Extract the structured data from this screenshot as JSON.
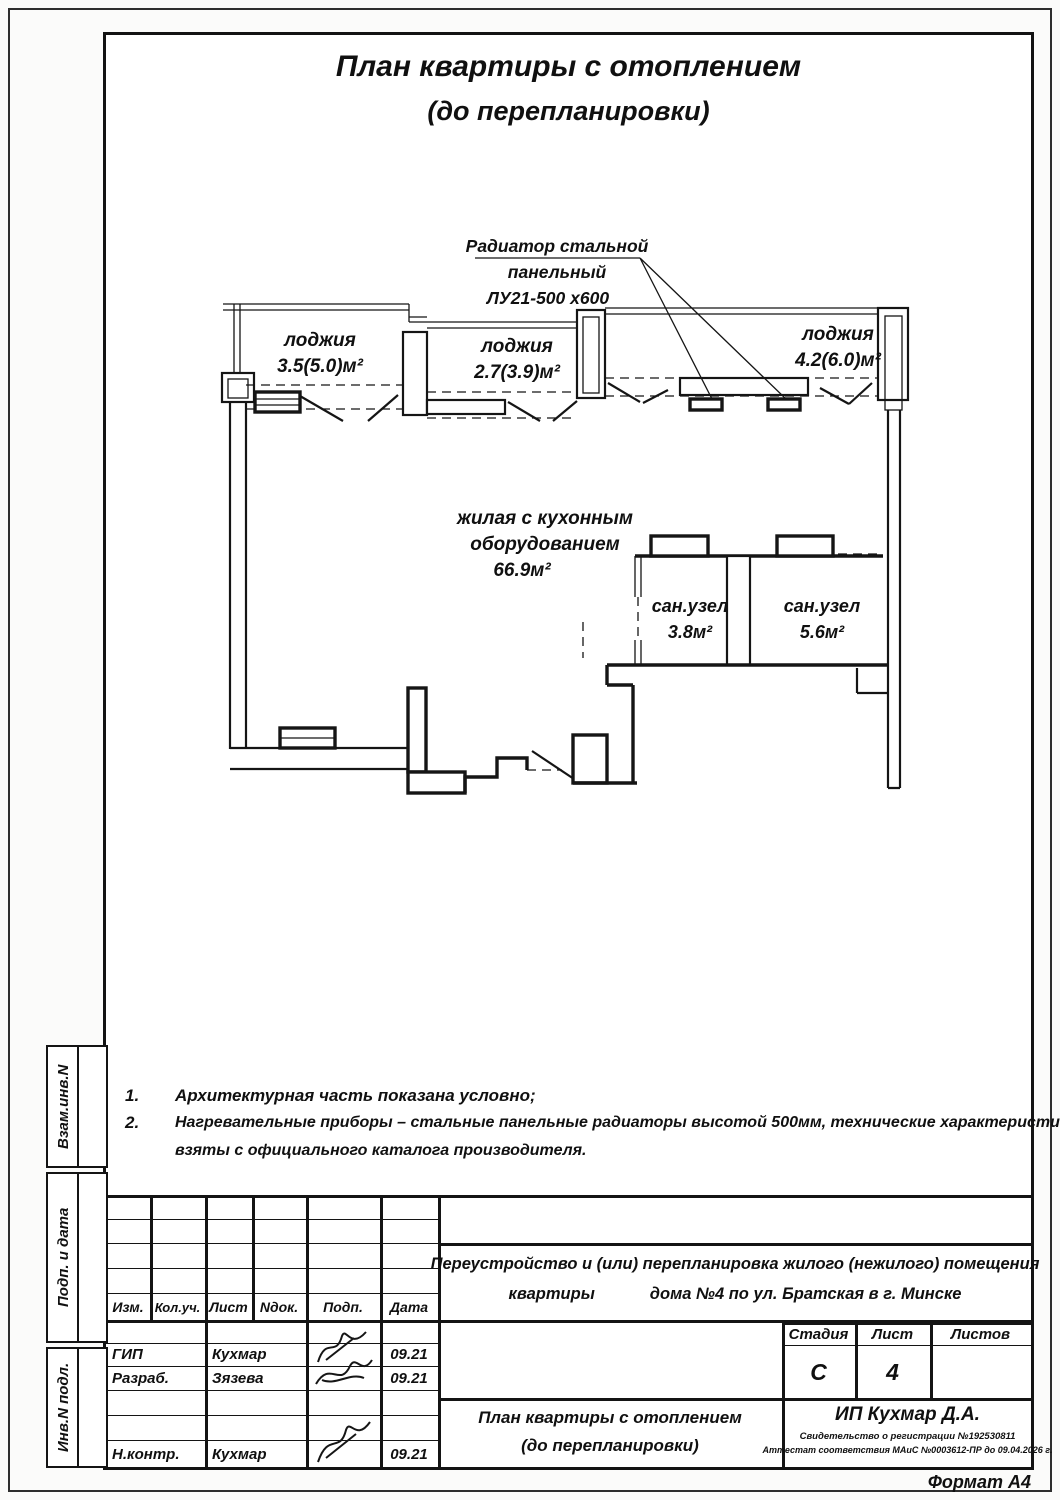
{
  "title": {
    "line1": "План квартиры с отоплением",
    "line2": "(до перепланировки)"
  },
  "plan": {
    "radiator_label": {
      "line1": "Радиатор стальной",
      "line2": "панельный",
      "line3": "ЛУ21-500 х600"
    },
    "loggia1": {
      "name": "лоджия",
      "area": "3.5(5.0)м²"
    },
    "loggia2": {
      "name": "лоджия",
      "area": "2.7(3.9)м²"
    },
    "loggia3": {
      "name": "лоджия",
      "area": "4.2(6.0)м²"
    },
    "living": {
      "line1": "жилая с кухонным",
      "line2": "оборудованием",
      "area": "66.9м²"
    },
    "san1": {
      "name": "сан.узел",
      "area": "3.8м²"
    },
    "san2": {
      "name": "сан.узел",
      "area": "5.6м²"
    }
  },
  "notes": {
    "item1": {
      "num": "1.",
      "text": "Архитектурная часть показана условно;"
    },
    "item2": {
      "num": "2.",
      "text": "Нагревательные приборы – стальные панельные радиаторы высотой 500мм, технические характеристики",
      "text2": "взяты с официального каталога производителя."
    }
  },
  "sidebar": {
    "group1": "Взам.инв.N",
    "group2": "Подп. и дата",
    "group3": "Инв.N подл."
  },
  "titleblock": {
    "columns": {
      "izm": "Изм.",
      "kol": "Кол.уч.",
      "list": "Лист",
      "ndok": "Nдок.",
      "podp": "Подп.",
      "data": "Дата"
    },
    "rows": [
      {
        "role": "ГИП",
        "name": "Кухмар",
        "date": "09.21"
      },
      {
        "role": "Разраб.",
        "name": "Зязева",
        "date": "09.21"
      },
      {
        "role": "Н.контр.",
        "name": "Кухмар",
        "date": "09.21"
      }
    ],
    "description": {
      "line1": "Переустройство и (или) перепланировка жилого (нежилого) помещения",
      "line2": "квартиры            дома №4 по ул. Братская в г. Минске"
    },
    "stage": {
      "label": "Стадия",
      "value": "С"
    },
    "sheet": {
      "label": "Лист",
      "value": "4"
    },
    "sheets": {
      "label": "Листов",
      "value": ""
    },
    "doc_title": {
      "line1": "План квартиры с отоплением",
      "line2": "(до перепланировки)"
    },
    "firm": {
      "name": "ИП Кухмар Д.А.",
      "cert1": "Свидетельство о регистрации №192530811",
      "cert2": "Аттестат соответствия МАиС №0003612-ПР до 09.04.2026 г."
    }
  },
  "footer": {
    "format": "Формат А4"
  }
}
